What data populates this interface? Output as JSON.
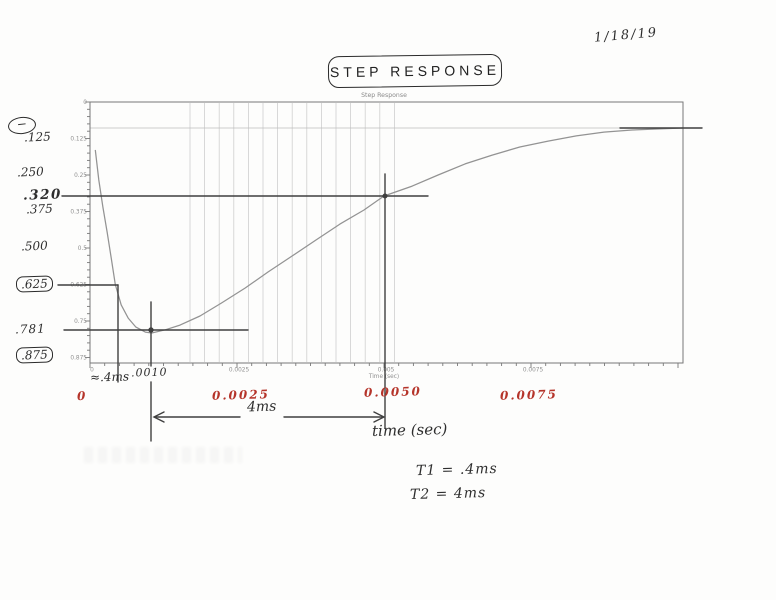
{
  "page": {
    "date": "1/18/19",
    "title": "STEP RESPONSE"
  },
  "chart": {
    "printed_title": "Step Response",
    "x_axis": {
      "label": "Time (sec)",
      "ticks": [
        "0",
        "0.0025",
        "0.005",
        "0.0075"
      ]
    },
    "y_axis": {
      "ticks": [
        "0",
        "0.125",
        "0.25",
        "0.375",
        "0.5",
        "0.625",
        "0.75",
        "0.875"
      ]
    }
  },
  "chart_data": {
    "type": "line",
    "title": "Step Response",
    "xlabel": "Time (sec)",
    "ylabel": "",
    "x_ticks": [
      0,
      0.0025,
      0.005,
      0.0075
    ],
    "y_ticks": [
      0,
      0.125,
      0.25,
      0.375,
      0.5,
      0.625,
      0.75,
      0.875
    ],
    "xlim": [
      0,
      0.0101
    ],
    "ylim": [
      0,
      0.875
    ],
    "y_axis_inverted": true,
    "polarity_note": "response is negative-going; hand-circled minus sign beside y-axis",
    "points": [
      [
        9e-05,
        0.164
      ],
      [
        0.00015,
        0.267
      ],
      [
        0.00022,
        0.36
      ],
      [
        0.00029,
        0.445
      ],
      [
        0.00036,
        0.534
      ],
      [
        0.00043,
        0.625
      ],
      [
        0.00053,
        0.695
      ],
      [
        0.00065,
        0.74
      ],
      [
        0.00078,
        0.771
      ],
      [
        0.00094,
        0.788
      ],
      [
        0.00105,
        0.791
      ],
      [
        0.00128,
        0.78
      ],
      [
        0.00153,
        0.764
      ],
      [
        0.00187,
        0.733
      ],
      [
        0.00224,
        0.688
      ],
      [
        0.00264,
        0.637
      ],
      [
        0.00303,
        0.582
      ],
      [
        0.00344,
        0.527
      ],
      [
        0.00384,
        0.473
      ],
      [
        0.00425,
        0.418
      ],
      [
        0.00466,
        0.37
      ],
      [
        0.005,
        0.322
      ],
      [
        0.00548,
        0.288
      ],
      [
        0.00592,
        0.25
      ],
      [
        0.00638,
        0.212
      ],
      [
        0.00684,
        0.182
      ],
      [
        0.00731,
        0.154
      ],
      [
        0.00779,
        0.134
      ],
      [
        0.00827,
        0.116
      ],
      [
        0.00874,
        0.103
      ],
      [
        0.00922,
        0.096
      ],
      [
        0.00969,
        0.092
      ],
      [
        0.01008,
        0.089
      ]
    ],
    "key_points": {
      "t1_level": {
        "t": 0.0004,
        "value": 0.625
      },
      "minimum": {
        "t": 0.001,
        "value": 0.781
      },
      "crossing": {
        "t": 0.005,
        "value": 0.32
      },
      "final_level_approx": 0.125
    }
  },
  "annotations": {
    "y_labels": [
      {
        "text": "−"
      },
      {
        "text": ".125"
      },
      {
        "text": ".250"
      },
      {
        "text": ".320"
      },
      {
        "text": ".375"
      },
      {
        "text": ".500"
      },
      {
        "text": ".625"
      },
      {
        "text": ".781"
      },
      {
        "text": ".875"
      }
    ],
    "x_red": [
      "0",
      "0.0025",
      "0.0050",
      "0.0075"
    ],
    "approx_4ms": "≈.4ms",
    "t_0010": ".0010",
    "four_ms": "4ms",
    "time_sec": "time (sec)",
    "t1": "T1 = .4ms",
    "t2": "T2 = 4ms"
  },
  "colors": {
    "red_ink": "#b5342a",
    "pen_ink": "#2e2e2e",
    "print_gray": "#8f8f8f"
  }
}
